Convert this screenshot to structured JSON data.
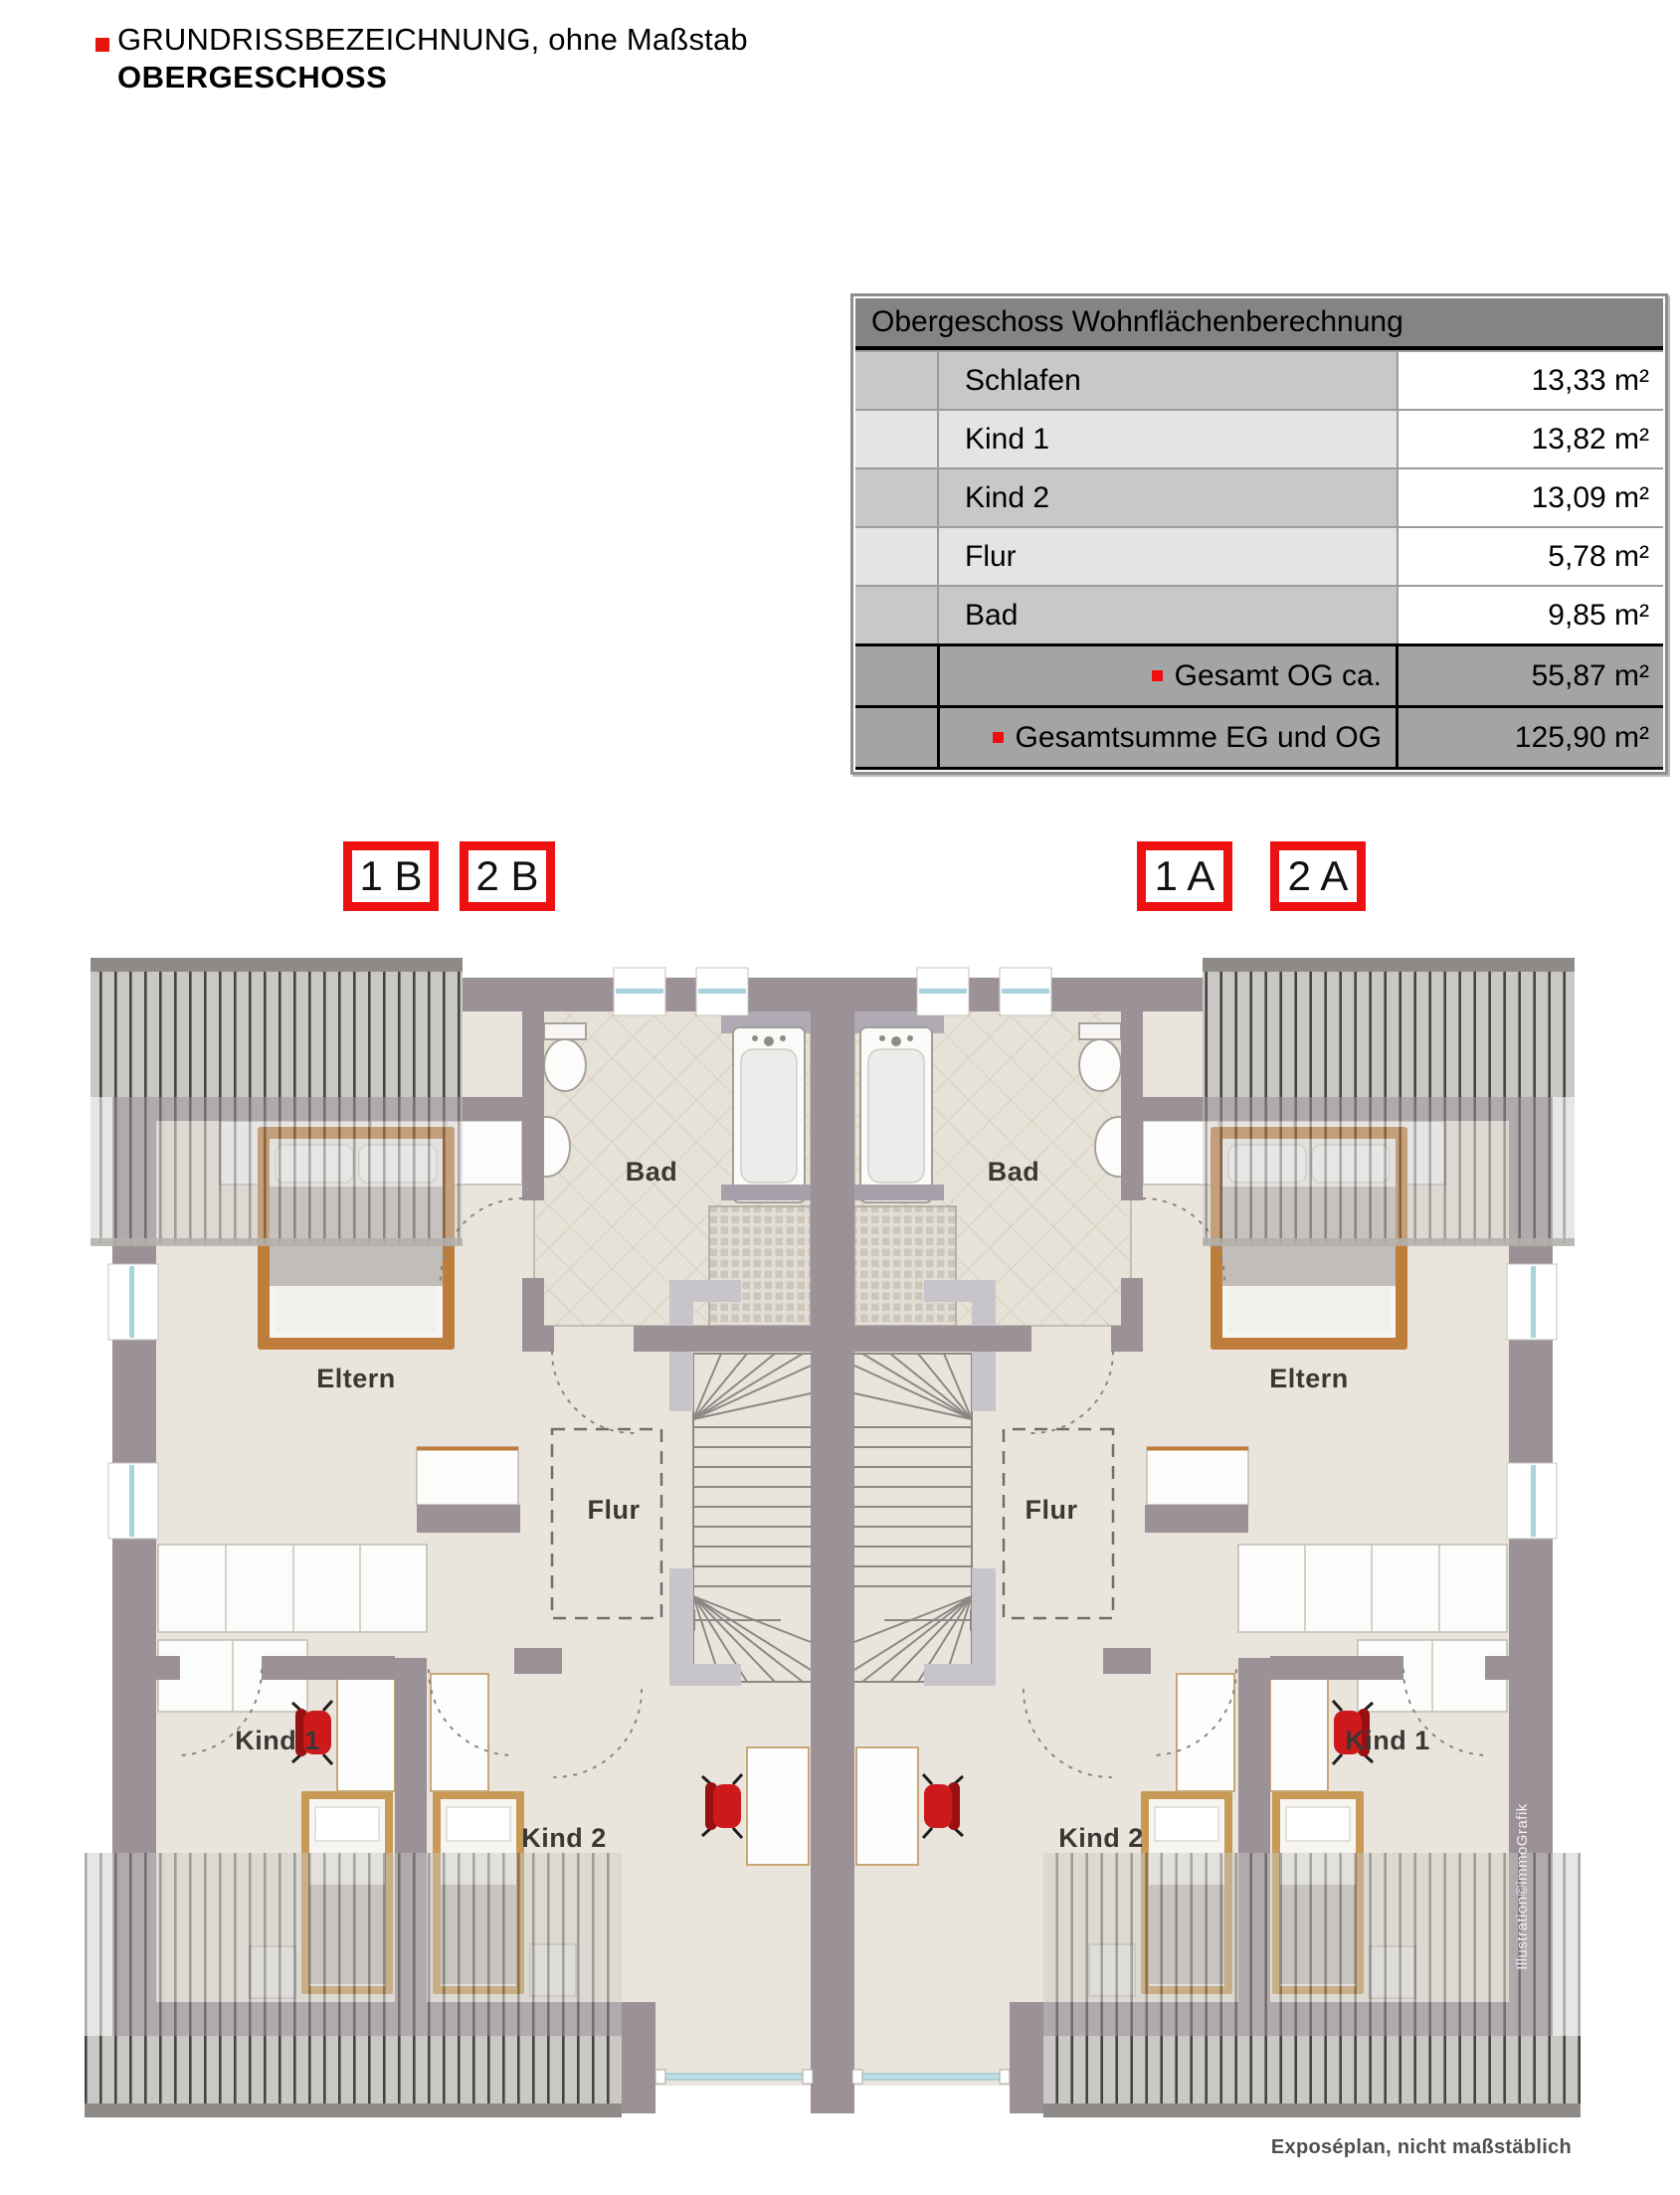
{
  "header": {
    "title": "GRUNDRISSBEZEICHNUNG, ohne Maßstab",
    "subtitle": "OBERGESCHOSS"
  },
  "table": {
    "title": "Obergeschoss Wohnflächenberechnung",
    "rows": [
      {
        "label": "Schlafen",
        "value": "13,33 m²"
      },
      {
        "label": "Kind 1",
        "value": "13,82 m²"
      },
      {
        "label": "Kind 2",
        "value": "13,09 m²"
      },
      {
        "label": "Flur",
        "value": "5,78 m²"
      },
      {
        "label": "Bad",
        "value": "9,85 m²"
      }
    ],
    "totals": [
      {
        "label": "Gesamt OG ca.",
        "value": "55,87 m²"
      },
      {
        "label": "Gesamtsumme EG und OG",
        "value": "125,90 m²"
      }
    ]
  },
  "unit_tags": [
    {
      "label": "1 B"
    },
    {
      "label": "2 B"
    },
    {
      "label": "1 A"
    },
    {
      "label": "2 A"
    }
  ],
  "plan": {
    "labels": {
      "bad_left": "Bad",
      "bad_right": "Bad",
      "eltern_left": "Eltern",
      "eltern_right": "Eltern",
      "flur_left": "Flur",
      "flur_right": "Flur",
      "kind1_left": "Kind 1",
      "kind1_right": "Kind 1",
      "kind2_left": "Kind 2",
      "kind2_right": "Kind 2"
    },
    "credit": "Illustration©immoGrafik",
    "footnote": "Exposéplan, nicht maßstäblich"
  },
  "colors": {
    "accent_red": "#ee1111",
    "wall": "#9b9197",
    "floor": "#eae5dc",
    "roof_hatch": "#cac8c5",
    "window_glass": "#a7d3db"
  }
}
